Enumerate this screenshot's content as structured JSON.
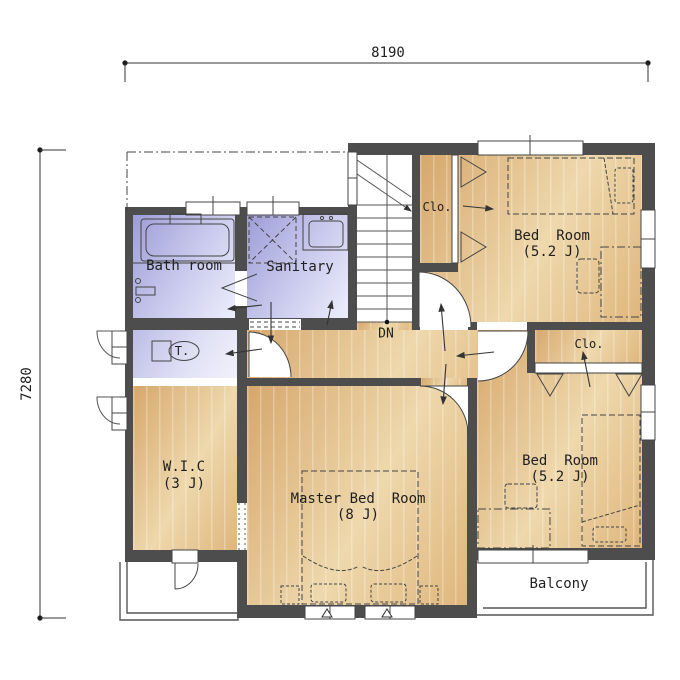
{
  "plan": {
    "dimensions": {
      "top": "8190",
      "left": "7280"
    },
    "rooms": {
      "bath": {
        "name": "Bath room"
      },
      "sanitary": {
        "name": "Sanitary"
      },
      "toilet": {
        "name": "T."
      },
      "closet_top": {
        "name": "Clo."
      },
      "bedroom_top": {
        "name": "Bed  Room",
        "size": "(5.2 J)"
      },
      "closet_right": {
        "name": "Clo."
      },
      "bedroom_right": {
        "name": "Bed  Room",
        "size": "(5.2 J)"
      },
      "wic": {
        "name": "W.I.C",
        "size": "(3 J)"
      },
      "master": {
        "name": "Master Bed  Room",
        "size": "(8 J)"
      },
      "balcony": {
        "name": "Balcony"
      },
      "stairs": {
        "name": "DN"
      }
    },
    "colors": {
      "wall": "#4d4d4d",
      "wood_floor": "#e6c28a",
      "wet_room": "#b9b9e4",
      "drawing_line": "#3c3c3c",
      "label_text": "#1f1f1f"
    }
  }
}
